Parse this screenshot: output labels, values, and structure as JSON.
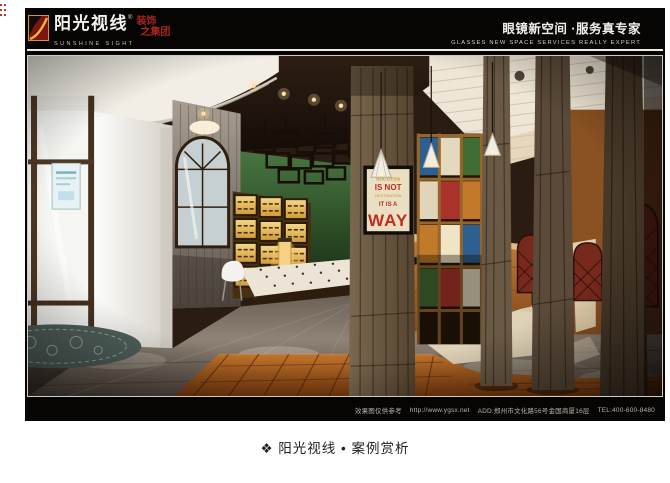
{
  "page": {
    "caption": "❖ 阳光视线 • 案例赏析"
  },
  "slide": {
    "header": {
      "brand_cn": "阳光视线",
      "reg_mark": "®",
      "brand_en": "SUNSHINE SIGHT",
      "brand_suffix_line1": "装饰",
      "brand_suffix_line2": "之集团",
      "tagline_cn": "眼镜新空间 ·服务真专家",
      "tagline_en": "GLASSES NEW SPACE SERVICES REALLY EXPERT"
    },
    "footer": {
      "disclaimer": "效果图仅供参考",
      "website": "http://www.ygsx.net",
      "address": "ADD:郑州市文化路56号金国商厦16层",
      "phone": "TEL:400-600-8480"
    },
    "photo": {
      "poster": {
        "line1": "SUCCESS",
        "line2": "IS NOT",
        "line3": "DESTINATION",
        "line4": "IT IS A",
        "line5": "WAY"
      },
      "palette": {
        "green_wall": "#3f6a39",
        "amber_display": "#e8b54e",
        "wood_floor": "#a75b1f",
        "grey_floor": "#8d8177",
        "rustic_wood": "#6b5a48",
        "accent_red": "#a9332a"
      }
    },
    "colors": {
      "slide_bg": "#070503",
      "brand_red": "#a82420",
      "logo_gold": "#d8a02a"
    }
  }
}
